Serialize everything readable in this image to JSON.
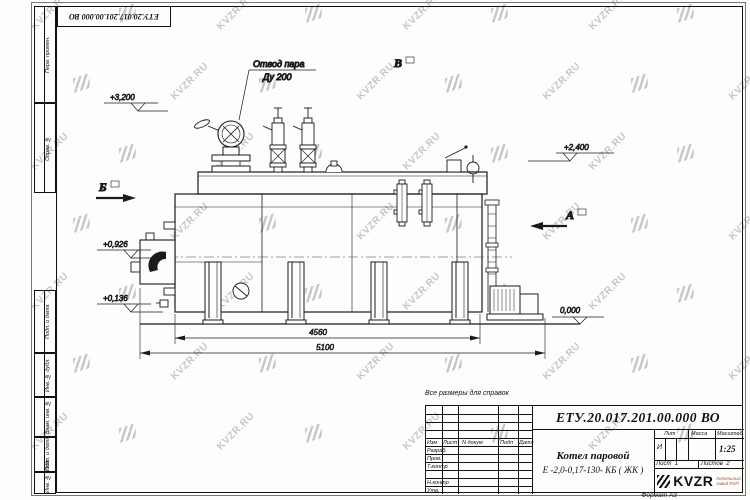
{
  "sheet": {
    "corner_doc_number": "ЕТУ.20.017.201.00.000  ВО",
    "reference_note": "Все размеры для справок",
    "format_note": "Формат А3"
  },
  "watermark": {
    "text": "KVZR.RU"
  },
  "margin_stamps": {
    "perv_primen": "Перв. примен.",
    "sprav_no": "Справ. №",
    "podp_data_1": "Подп. и дата",
    "inv_dubl": "Инв. № дубл.",
    "vzam_inv": "Взам. инв. №",
    "podp_data_2": "Подп. и дата",
    "inv_podl": "Инв. № подл."
  },
  "drawing": {
    "steam_outlet_label_line1": "Отвод пара",
    "steam_outlet_label_line2": "Ду 200",
    "elevations": {
      "top": "+3,200",
      "steam_drum": "+2,400",
      "burner_axis": "+0,926",
      "lower": "+0,136",
      "zero": "0,000"
    },
    "sections": {
      "a": "А",
      "b": "Б",
      "v": "В"
    },
    "dimensions": {
      "inner_length": "4560",
      "overall_length": "5100"
    }
  },
  "title_block": {
    "doc_number": "ЕТУ.20.017.201.00.000  ВО",
    "product_name_line1": "Котел паровой",
    "product_name_line2": "Е -2,0-0,17-130- КБ ( ЖК )",
    "col_headers": {
      "izm": "Изм",
      "list": "Лист",
      "doc": "N докум",
      "podp": "Подп",
      "data": "Дата"
    },
    "row_labels": {
      "razrab": "Разраб.",
      "prov": "Пров.",
      "t_kontr": "Т.контр",
      "n_kontr": "Н.контр",
      "utv": "Утв."
    },
    "stat_headers": {
      "lit": "Лит",
      "massa": "Масса",
      "masshtab": "Масштаб"
    },
    "lit_value": "И",
    "scale_value": "1:25",
    "sheet_label": "Лист",
    "sheet_value": "1",
    "sheets_label": "Листов",
    "sheets_value": "2",
    "logo_text": "KVZR",
    "logo_caption_line1": "Котельный",
    "logo_caption_line2": "завод РЭП"
  }
}
